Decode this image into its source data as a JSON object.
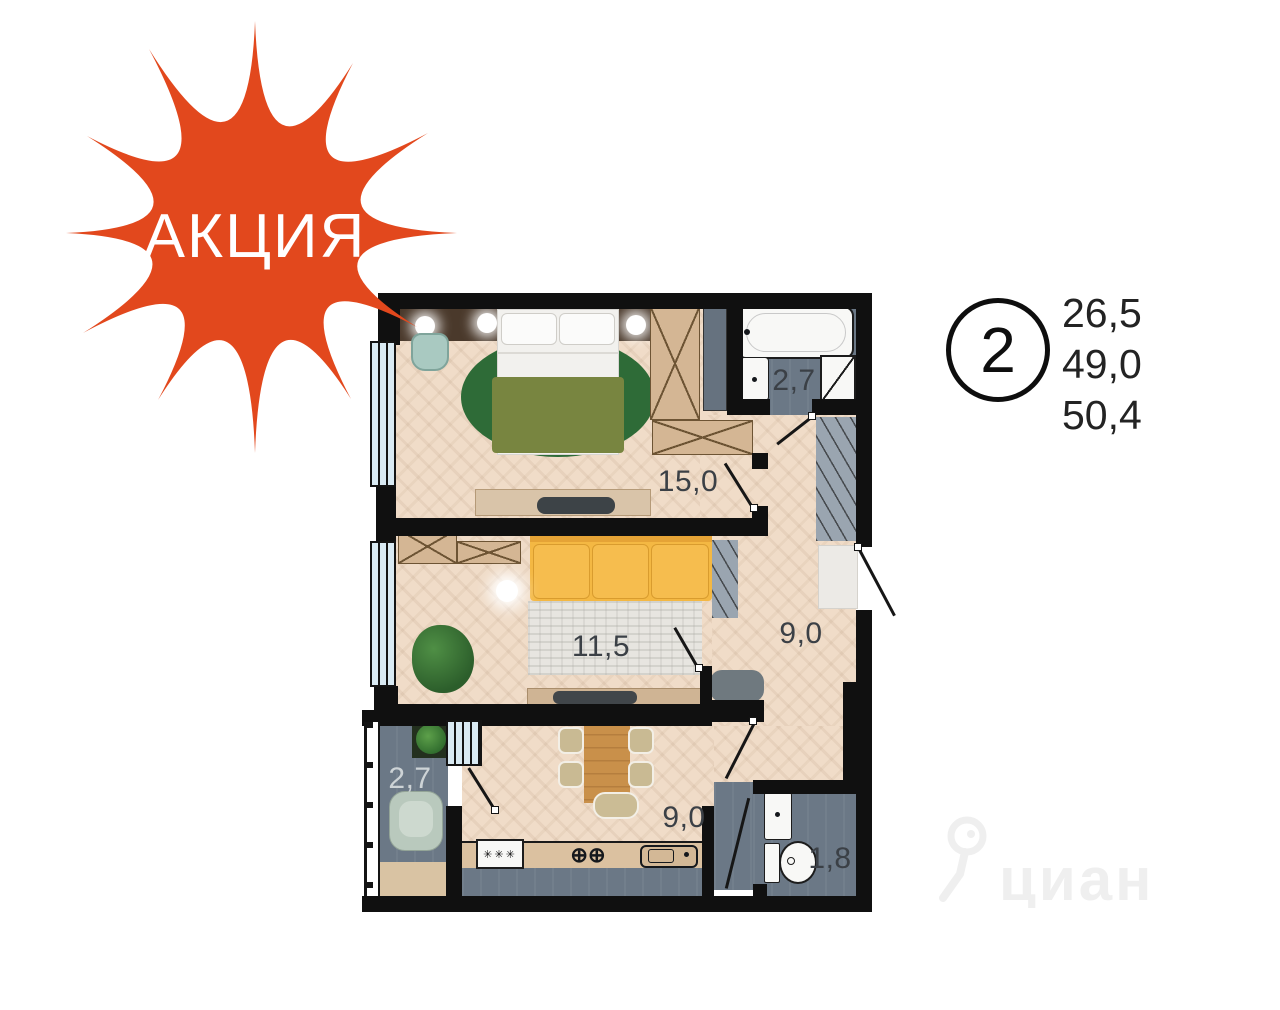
{
  "promo": {
    "label": "АКЦИЯ"
  },
  "summary": {
    "room_count": "2",
    "areas": [
      "26,5",
      "49,0",
      "50,4"
    ]
  },
  "plan": {
    "rooms": [
      {
        "id": "bedroom",
        "area": "15,0"
      },
      {
        "id": "living-room",
        "area": "11,5"
      },
      {
        "id": "hallway",
        "area": "9,0"
      },
      {
        "id": "bathroom",
        "area": "2,7"
      },
      {
        "id": "kitchen",
        "area": "9,0"
      },
      {
        "id": "balcony",
        "area": "2,7"
      },
      {
        "id": "wc",
        "area": "1,8"
      }
    ],
    "icons": {
      "stove_burners": "✳✳✳",
      "sink_taps": "⊕⊕"
    }
  },
  "watermark": {
    "label": "циан"
  },
  "colors": {
    "accent": "#e2481d",
    "wall": "#101010",
    "wood": "#f0dcc8",
    "tile": "#6b7886",
    "wardrobe": "#d4b694",
    "wardrobe_line": "#6d5434",
    "sofa": "#f4b843",
    "sofa_dark": "#e5a336",
    "blanket": "#788540",
    "rug_bedroom": "#2e6b37",
    "rug_living": "#e7e5e0",
    "window_glass": "#d9eaf3",
    "counter": "#dbc1a0",
    "table_wood": "#c9904a",
    "headboard": "#4a392b",
    "fixture_white": "#f8f8f6",
    "label_dark": "#3b4046",
    "label_light": "#cdd3d6"
  }
}
